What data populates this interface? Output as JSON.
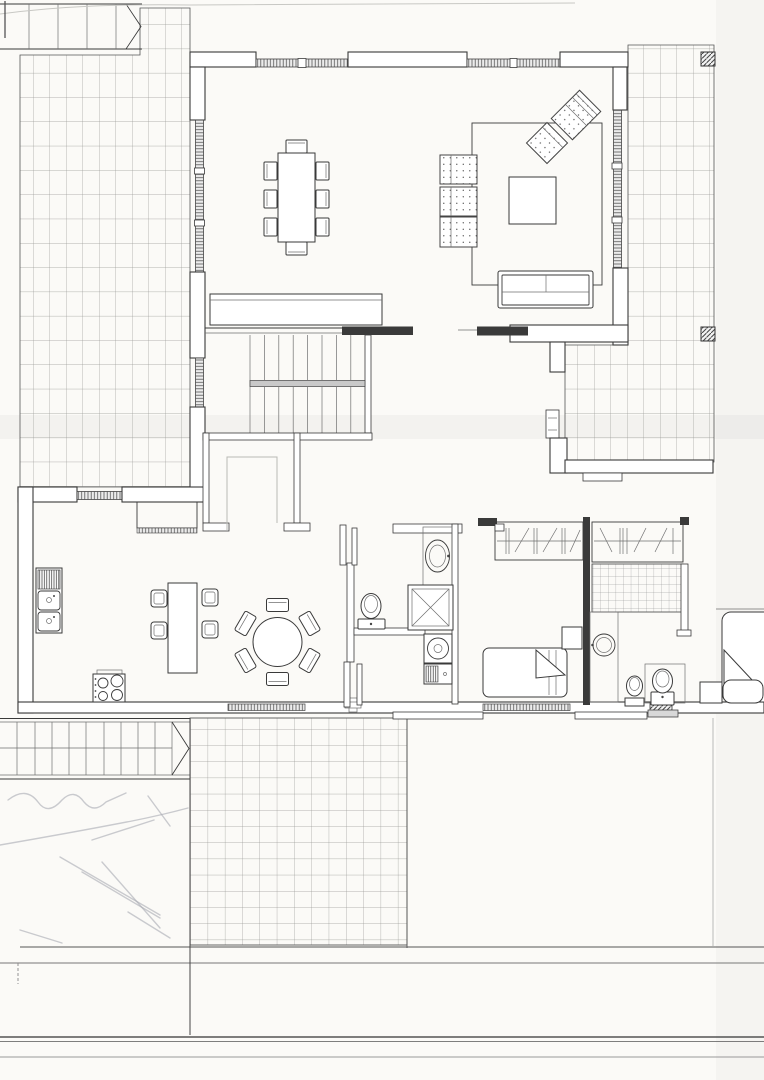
{
  "document": {
    "kind": "scanned architectural floor plan",
    "visible_text": "",
    "page_width_px": 764,
    "page_height_px": 1080
  },
  "palette": {
    "paper": "#fbfaf7",
    "ink": "#3a3a3a",
    "wall": "#ffffff",
    "grid": "#9b9b98",
    "fine": "#6f6f6f",
    "pencil": "#a8aab2",
    "scan": "#8a8a90"
  },
  "features": [
    "exterior-stair-top-left",
    "tiled-terrace-top-left",
    "dining-area",
    "dining-table",
    "dining-chairs-x8",
    "sideboard",
    "living-area",
    "area-rug",
    "coffee-table",
    "dotted-armchairs-x3",
    "rotated-armchair",
    "rotated-loveseat",
    "sofa",
    "window-bands-hatched",
    "staircase-two-flights",
    "under-stair-closet",
    "kitchen",
    "double-sink-with-drainer",
    "kitchen-island",
    "bar-stools-x4",
    "cooktop-4-burner",
    "round-table-with-6-chairs",
    "upper-cabinet",
    "bathroom-1",
    "oval-washbasin",
    "shower-with-x",
    "toilet",
    "washing-machine",
    "laundry-unit",
    "door-leaves",
    "hallway",
    "wardrobe-with-hanging-symbols",
    "bedroom-1",
    "single-bed-with-folded-blanket",
    "nightstand",
    "dark-partition-wall",
    "bathroom-2",
    "round-vanity-basin",
    "tiled-shower-floor",
    "bidet",
    "toilet-2",
    "bedroom-2",
    "double-bed-corner",
    "tiled-terrace-right",
    "hatched-columns",
    "tiled-terrace-bottom",
    "exterior-stair-bottom-left",
    "garden-area",
    "pencil-sketch-scribbles",
    "property-boundary-lines",
    "scanner-band-artifact"
  ],
  "counts": {
    "dining_chairs": 8,
    "round_table_chairs": 6,
    "bar_stools": 4,
    "armchairs_dotted": 3,
    "hatched_columns": 3,
    "terraces": 3,
    "stair_flights_exterior": 2
  }
}
